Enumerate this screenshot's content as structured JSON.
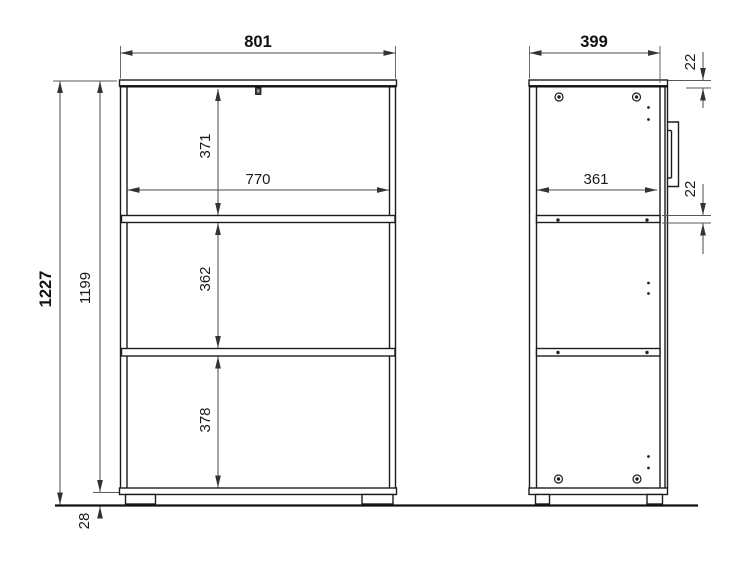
{
  "drawing": {
    "front_view": {
      "overall_width": "801",
      "overall_height": "1227",
      "body_height": "1199",
      "plinth_height": "28",
      "inner_width": "770",
      "top_compartment": "371",
      "middle_compartment": "362",
      "bottom_compartment": "378"
    },
    "side_view": {
      "overall_depth": "399",
      "inner_depth": "361",
      "top_panel_thickness": "22",
      "shelf_thickness": "22"
    }
  }
}
